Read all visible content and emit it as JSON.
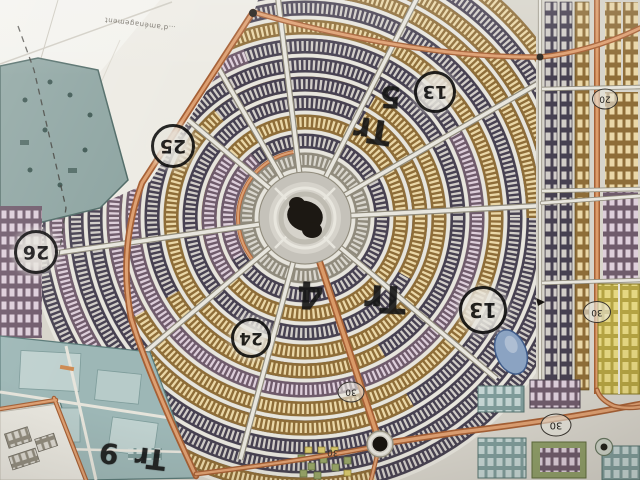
{
  "map": {
    "annotations": {
      "handwritten": [
        {
          "id": "tr5",
          "label": "Tr 5"
        },
        {
          "id": "tr4",
          "label": "Tr 4"
        },
        {
          "id": "tr9",
          "label": "Tr 9"
        }
      ],
      "circled": [
        {
          "id": "c25",
          "label": "25"
        },
        {
          "id": "c26",
          "label": "26"
        },
        {
          "id": "c24",
          "label": "24"
        },
        {
          "id": "c13a",
          "label": "13"
        },
        {
          "id": "c13b",
          "label": "13"
        }
      ],
      "road_widths": [
        {
          "id": "r30a",
          "label": "30"
        },
        {
          "id": "r20",
          "label": "20"
        },
        {
          "id": "r30b",
          "label": "30"
        },
        {
          "id": "r30c",
          "label": "30"
        },
        {
          "id": "r30d",
          "label": "30"
        }
      ],
      "printed": [
        {
          "id": "plan-edge-label",
          "label": "…d'aménagement"
        }
      ]
    },
    "palette": {
      "paper": "#d8d5cb",
      "paper_light": "#f0eee8",
      "road_orange": "#c97f50",
      "parcel_dark": "#474051",
      "parcel_dark_cell": "#d2cec9",
      "parcel_tan": "#8f6d36",
      "parcel_tan_cell": "#ecd8a6",
      "parcel_pink": "#6f5a6b",
      "parcel_pink_cell": "#decfdb",
      "park_teal": "#8ea6a2",
      "facility_teal": "#9db8b7",
      "zone_yellow": "#e0cf6d",
      "zone_green": "#8f9e66",
      "pond_blue": "#8aa3c4",
      "marker_ink": "#141414",
      "monument_dark": "#1b1712"
    }
  }
}
